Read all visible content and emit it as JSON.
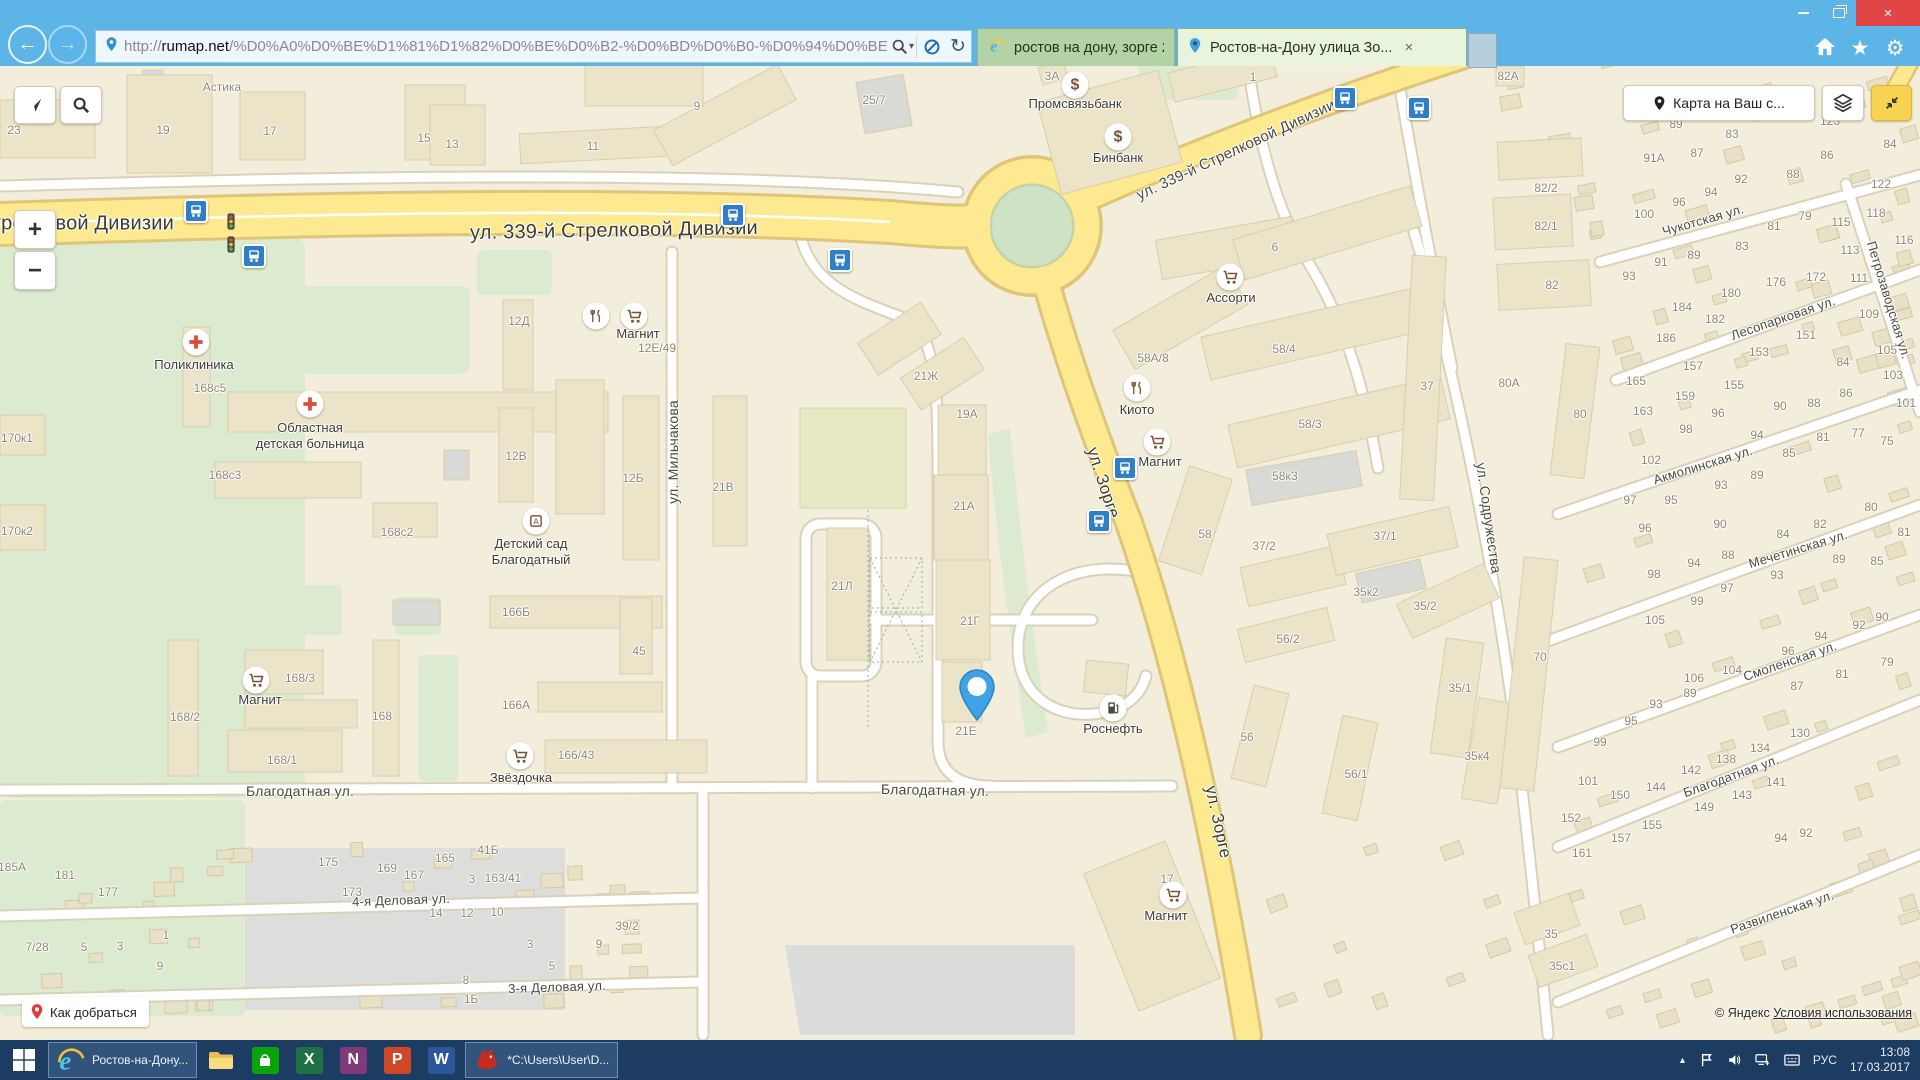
{
  "browser": {
    "titlebar": {
      "minimize": "–",
      "close": "×"
    },
    "nav": {
      "back": "←",
      "forward": "→",
      "url_prefix": "http://",
      "url_domain": "rumap.net",
      "url_path": "/%D0%A0%D0%BE%D1%81%D1%82%D0%BE%D0%B2-%D0%BD%D0%B0-%D0%94%D0%BE",
      "search_caret": "▾",
      "refresh": "↻"
    },
    "tabs": [
      {
        "title": "ростов на дону, зорге 21Е — ...",
        "icon": "ie",
        "active": false
      },
      {
        "title": "Ростов-на-Дону улица Зо...",
        "icon": "pin",
        "active": true,
        "close": "×"
      }
    ],
    "right_icons": {
      "star": "★",
      "gear": "⚙"
    }
  },
  "map": {
    "buttons": {
      "route": "Как добраться",
      "share": "Карта на Ваш с...",
      "zoom_in": "+",
      "zoom_out": "−"
    },
    "attribution": {
      "copyright": "© Яндекс",
      "terms": "Условия использования"
    },
    "marker": {
      "x": 977,
      "y": 726,
      "label": "21Е"
    },
    "streets": [
      [
        "ул. 339-й Стрелковой Дивизии",
        614,
        231,
        -1,
        20,
        1
      ],
      [
        "ул. 339-й Стрелковой Дивизии",
        30,
        224,
        0,
        20,
        1
      ],
      [
        "ул. 339-й Стрелковой Дивизии",
        1236,
        150,
        -25,
        15,
        0
      ],
      [
        "ул. Мильчакова",
        673,
        452,
        -90,
        14,
        0
      ],
      [
        "ул. Зорге",
        1103,
        483,
        72,
        17,
        1
      ],
      [
        "ул. Зорге",
        1218,
        822,
        78,
        17,
        1
      ],
      [
        "ул. Содружества",
        1489,
        518,
        82,
        14,
        0
      ],
      [
        "Благодатная ул.",
        300,
        791,
        0,
        14,
        0
      ],
      [
        "Благодатная ул.",
        935,
        790,
        1,
        14,
        0
      ],
      [
        "Благодатная ул.",
        1731,
        776,
        -20,
        13,
        0
      ],
      [
        "Смоленская ул.",
        1790,
        661,
        -19,
        13,
        0
      ],
      [
        "Мечетинская ул.",
        1798,
        549,
        -17,
        13,
        0
      ],
      [
        "Акмолинская ул.",
        1703,
        465,
        -17,
        13,
        0
      ],
      [
        "Чукотская ул.",
        1703,
        220,
        -16,
        13,
        0
      ],
      [
        "Лесопарковая ул.",
        1783,
        318,
        -19,
        13,
        0
      ],
      [
        "Петрозаводская ул.",
        1889,
        300,
        73,
        13,
        0
      ],
      [
        "Развиленская ул.",
        1782,
        912,
        -19,
        13,
        0
      ],
      [
        "4-я Деловая ул.",
        401,
        900,
        -2,
        13,
        0
      ],
      [
        "3-я Деловая ул.",
        557,
        987,
        -2,
        13,
        0
      ]
    ],
    "labels": [
      [
        "23",
        14,
        130
      ],
      [
        "19",
        163,
        130
      ],
      [
        "17",
        270,
        131
      ],
      [
        "Астика",
        222,
        87
      ],
      [
        "15",
        424,
        138
      ],
      [
        "13",
        452,
        144
      ],
      [
        "11",
        593,
        146
      ],
      [
        "9",
        697,
        106
      ],
      [
        "25/7",
        874,
        100
      ],
      [
        "3А",
        1052,
        76
      ],
      [
        "1",
        1253,
        77
      ],
      [
        "6",
        1275,
        247
      ],
      [
        "12Д",
        519,
        321
      ],
      [
        "12В",
        516,
        456
      ],
      [
        "12Б",
        633,
        478
      ],
      [
        "21В",
        723,
        487
      ],
      [
        "21Ж",
        926,
        376
      ],
      [
        "19А",
        967,
        414
      ],
      [
        "21А",
        964,
        506
      ],
      [
        "21Л",
        842,
        586
      ],
      [
        "21Г",
        970,
        621
      ],
      [
        "45",
        639,
        651
      ],
      [
        "12Е/49",
        657,
        348
      ],
      [
        "170к1",
        17,
        438
      ],
      [
        "170к2",
        17,
        531
      ],
      [
        "168с5",
        210,
        388
      ],
      [
        "168с3",
        225,
        475
      ],
      [
        "168с2",
        397,
        532
      ],
      [
        "166Б",
        516,
        612
      ],
      [
        "166А",
        516,
        705
      ],
      [
        "168/2",
        185,
        717
      ],
      [
        "168",
        382,
        716
      ],
      [
        "168/1",
        282,
        760
      ],
      [
        "166/43",
        576,
        755
      ],
      [
        "168/3",
        300,
        678
      ],
      [
        "185А",
        12,
        867
      ],
      [
        "181",
        65,
        875
      ],
      [
        "177",
        108,
        892
      ],
      [
        "175",
        328,
        862
      ],
      [
        "173",
        352,
        892
      ],
      [
        "169",
        387,
        868
      ],
      [
        "167",
        414,
        875
      ],
      [
        "165",
        445,
        858
      ],
      [
        "41Б",
        488,
        850
      ],
      [
        "3",
        472,
        879
      ],
      [
        "163/41",
        503,
        878
      ],
      [
        "14",
        436,
        913
      ],
      [
        "12",
        467,
        913
      ],
      [
        "10",
        497,
        912
      ],
      [
        "39/2",
        627,
        926
      ],
      [
        "9",
        599,
        944
      ],
      [
        "3",
        530,
        944
      ],
      [
        "5",
        552,
        966
      ],
      [
        "8",
        466,
        980
      ],
      [
        "1Б",
        471,
        999
      ],
      [
        "7/28",
        37,
        947
      ],
      [
        "5",
        84,
        947
      ],
      [
        "3",
        120,
        946
      ],
      [
        "1",
        166,
        935
      ],
      [
        "9",
        160,
        966
      ],
      [
        "58А/8",
        1153,
        358
      ],
      [
        "58/4",
        1284,
        349
      ],
      [
        "58/3",
        1310,
        424
      ],
      [
        "58кЗ",
        1285,
        476
      ],
      [
        "58",
        1205,
        534
      ],
      [
        "37",
        1427,
        386
      ],
      [
        "37/2",
        1264,
        546
      ],
      [
        "37/1",
        1385,
        536
      ],
      [
        "56/2",
        1288,
        639
      ],
      [
        "56",
        1247,
        737
      ],
      [
        "56/1",
        1356,
        774
      ],
      [
        "35к2",
        1366,
        592
      ],
      [
        "35/2",
        1425,
        606
      ],
      [
        "35/1",
        1460,
        688
      ],
      [
        "35к4",
        1477,
        756
      ],
      [
        "70",
        1540,
        657
      ],
      [
        "35",
        1551,
        934
      ],
      [
        "35с1",
        1562,
        966
      ],
      [
        "17",
        1167,
        879
      ],
      [
        "82А",
        1508,
        76
      ],
      [
        "82/2",
        1546,
        188
      ],
      [
        "82/1",
        1546,
        226
      ],
      [
        "82",
        1552,
        285
      ],
      [
        "80А",
        1509,
        383
      ],
      [
        "80",
        1580,
        414
      ],
      [
        "89",
        1676,
        124
      ],
      [
        "83",
        1732,
        134
      ],
      [
        "87",
        1697,
        153
      ],
      [
        "91А",
        1654,
        158
      ],
      [
        "86",
        1827,
        155
      ],
      [
        "88",
        1793,
        174
      ],
      [
        "92",
        1741,
        179
      ],
      [
        "94",
        1711,
        192
      ],
      [
        "96",
        1679,
        202
      ],
      [
        "100",
        1644,
        214
      ],
      [
        "123",
        1830,
        121
      ],
      [
        "84",
        1890,
        144
      ],
      [
        "122",
        1881,
        184
      ],
      [
        "118",
        1876,
        213
      ],
      [
        "79",
        1805,
        216
      ],
      [
        "81",
        1774,
        226
      ],
      [
        "115",
        1841,
        222
      ],
      [
        "113",
        1850,
        250
      ],
      [
        "83",
        1742,
        246
      ],
      [
        "89",
        1694,
        255
      ],
      [
        "91",
        1661,
        262
      ],
      [
        "93",
        1629,
        276
      ],
      [
        "116",
        1904,
        240
      ],
      [
        "176",
        1776,
        282
      ],
      [
        "172",
        1816,
        277
      ],
      [
        "111",
        1859,
        278
      ],
      [
        "180",
        1731,
        293
      ],
      [
        "184",
        1682,
        307
      ],
      [
        "182",
        1715,
        319
      ],
      [
        "186",
        1666,
        338
      ],
      [
        "151",
        1806,
        335
      ],
      [
        "153",
        1759,
        352
      ],
      [
        "157",
        1693,
        366
      ],
      [
        "109",
        1869,
        314
      ],
      [
        "105",
        1887,
        350
      ],
      [
        "84",
        1843,
        362
      ],
      [
        "103",
        1893,
        375
      ],
      [
        "101",
        1906,
        403
      ],
      [
        "165",
        1636,
        381
      ],
      [
        "163",
        1643,
        411
      ],
      [
        "159",
        1685,
        396
      ],
      [
        "155",
        1734,
        385
      ],
      [
        "98",
        1686,
        429
      ],
      [
        "96",
        1718,
        413
      ],
      [
        "90",
        1780,
        406
      ],
      [
        "88",
        1814,
        403
      ],
      [
        "86",
        1846,
        393
      ],
      [
        "94",
        1757,
        435
      ],
      [
        "81",
        1823,
        437
      ],
      [
        "77",
        1858,
        433
      ],
      [
        "75",
        1887,
        441
      ],
      [
        "102",
        1651,
        460
      ],
      [
        "97",
        1630,
        500
      ],
      [
        "95",
        1671,
        500
      ],
      [
        "93",
        1721,
        485
      ],
      [
        "89",
        1757,
        475
      ],
      [
        "85",
        1789,
        453
      ],
      [
        "96",
        1645,
        528
      ],
      [
        "90",
        1720,
        524
      ],
      [
        "84",
        1783,
        534
      ],
      [
        "82",
        1820,
        524
      ],
      [
        "88",
        1728,
        555
      ],
      [
        "94",
        1694,
        563
      ],
      [
        "98",
        1654,
        574
      ],
      [
        "93",
        1777,
        575
      ],
      [
        "97",
        1727,
        588
      ],
      [
        "99",
        1697,
        601
      ],
      [
        "80",
        1871,
        507
      ],
      [
        "81",
        1904,
        532
      ],
      [
        "89",
        1839,
        559
      ],
      [
        "85",
        1877,
        561
      ],
      [
        "105",
        1655,
        620
      ],
      [
        "106",
        1694,
        678
      ],
      [
        "104",
        1732,
        670
      ],
      [
        "90",
        1882,
        617
      ],
      [
        "92",
        1859,
        625
      ],
      [
        "94",
        1821,
        636
      ],
      [
        "96",
        1788,
        651
      ],
      [
        "87",
        1797,
        686
      ],
      [
        "81",
        1842,
        674
      ],
      [
        "79",
        1887,
        662
      ],
      [
        "89",
        1690,
        693
      ],
      [
        "93",
        1656,
        704
      ],
      [
        "95",
        1631,
        721
      ],
      [
        "99",
        1600,
        742
      ],
      [
        "101",
        1588,
        781
      ],
      [
        "150",
        1620,
        795
      ],
      [
        "144",
        1656,
        787
      ],
      [
        "142",
        1691,
        770
      ],
      [
        "138",
        1726,
        759
      ],
      [
        "134",
        1760,
        748
      ],
      [
        "130",
        1800,
        733
      ],
      [
        "141",
        1776,
        782
      ],
      [
        "143",
        1742,
        795
      ],
      [
        "149",
        1704,
        807
      ],
      [
        "152",
        1571,
        818
      ],
      [
        "155",
        1652,
        825
      ],
      [
        "157",
        1621,
        838
      ],
      [
        "161",
        1582,
        853
      ],
      [
        "94",
        1781,
        838
      ],
      [
        "92",
        1806,
        833
      ]
    ],
    "pois": [
      {
        "i": "med",
        "t": "Поликлиника",
        "x": 196,
        "y": 342,
        "lx": 194,
        "ly": 357
      },
      {
        "i": "med",
        "t": "Областная\nдетская больница",
        "x": 310,
        "y": 404,
        "lx": 310,
        "ly": 420
      },
      {
        "i": "kinder",
        "t": "Детский сад\nБлагодатный",
        "x": 536,
        "y": 521,
        "lx": 531,
        "ly": 536
      },
      {
        "i": "food",
        "t": "",
        "x": 596,
        "y": 316,
        "lx": 0,
        "ly": 0
      },
      {
        "i": "cart",
        "t": "Магнит",
        "x": 634,
        "y": 316,
        "lx": 638,
        "ly": 326
      },
      {
        "i": "cart",
        "t": "Магнит",
        "x": 256,
        "y": 680,
        "lx": 260,
        "ly": 692
      },
      {
        "i": "cart",
        "t": "Звёздочка",
        "x": 520,
        "y": 756,
        "lx": 521,
        "ly": 770
      },
      {
        "i": "bank",
        "t": "Промсвязьбанк",
        "x": 1075,
        "y": 85,
        "lx": 1075,
        "ly": 96
      },
      {
        "i": "bank",
        "t": "Бинбанк",
        "x": 1118,
        "y": 137,
        "lx": 1118,
        "ly": 150
      },
      {
        "i": "cart",
        "t": "Ассорти",
        "x": 1230,
        "y": 277,
        "lx": 1231,
        "ly": 290
      },
      {
        "i": "food",
        "t": "Киото",
        "x": 1137,
        "y": 388,
        "lx": 1137,
        "ly": 402
      },
      {
        "i": "cart",
        "t": "Магнит",
        "x": 1157,
        "y": 442,
        "lx": 1160,
        "ly": 454
      },
      {
        "i": "fuel",
        "t": "Роснефть",
        "x": 1113,
        "y": 708,
        "lx": 1113,
        "ly": 721
      },
      {
        "i": "cart",
        "t": "Магнит",
        "x": 1173,
        "y": 895,
        "lx": 1166,
        "ly": 908
      }
    ],
    "bus_stops": [
      [
        196,
        211
      ],
      [
        254,
        256
      ],
      [
        733,
        215
      ],
      [
        840,
        260
      ],
      [
        1345,
        98
      ],
      [
        1419,
        108
      ],
      [
        1125,
        468
      ],
      [
        1099,
        521
      ]
    ],
    "traffic_lights": [
      [
        231,
        224
      ],
      [
        231,
        247
      ]
    ]
  },
  "taskbar": {
    "apps": [
      {
        "icon": "start",
        "label": "",
        "active": false
      },
      {
        "icon": "ie",
        "label": "Ростов-на-Дону...",
        "active": true
      },
      {
        "icon": "folder",
        "label": "",
        "active": false
      },
      {
        "icon": "store",
        "label": "",
        "active": false
      },
      {
        "icon": "excel",
        "label": "",
        "active": false
      },
      {
        "icon": "onenote",
        "label": "",
        "active": false
      },
      {
        "icon": "powerpoint",
        "label": "",
        "active": false
      },
      {
        "icon": "word",
        "label": "",
        "active": false
      },
      {
        "icon": "dragon",
        "label": "*C:\\Users\\User\\D...",
        "active": true
      }
    ],
    "tray": {
      "hidden": "▲",
      "lang": "РУС",
      "time": "13:08",
      "date": "17.03.2017"
    }
  }
}
